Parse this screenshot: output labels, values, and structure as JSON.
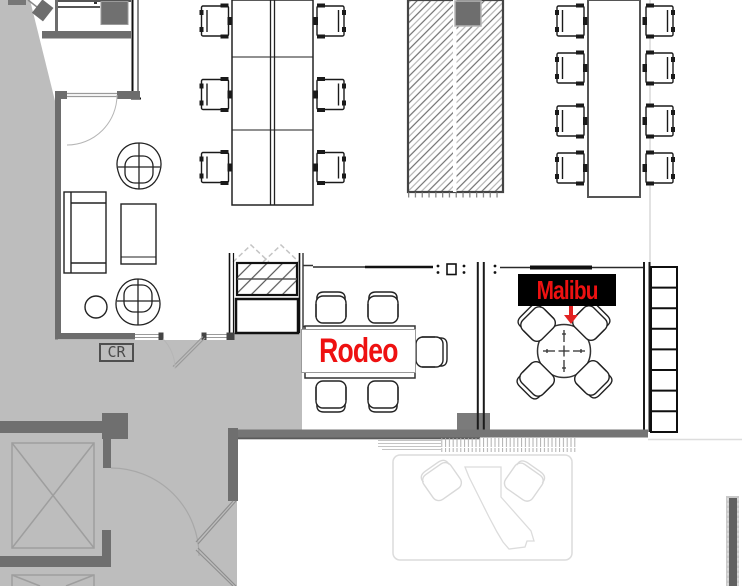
{
  "plan": {
    "title": "office-floor-plan",
    "rooms": [
      {
        "id": "rodeo",
        "label": "Rodeo",
        "label_color": "#ee1111",
        "label_bg": "#ffffff",
        "furniture": "rect-table-5-chairs"
      },
      {
        "id": "malibu",
        "label": "Malibu",
        "label_color": "#ee1111",
        "label_bg": "#000000",
        "furniture": "round-table-4-chairs",
        "marker": "red-down-arrow"
      }
    ],
    "badges": [
      {
        "id": "cr",
        "label": "CR"
      }
    ],
    "areas": [
      {
        "id": "open-desk-bank",
        "desks": 6,
        "chairs": 6
      },
      {
        "id": "long-table",
        "chairs": 8
      },
      {
        "id": "hatched-zone",
        "pattern": "diagonal-hatch"
      },
      {
        "id": "lounge",
        "items": [
          "sofa",
          "coffee-table",
          "2 lounge chairs",
          "side-table"
        ]
      },
      {
        "id": "locker-column",
        "cells": 8
      },
      {
        "id": "elevator-core",
        "shafts": 2
      },
      {
        "id": "ghost-rug",
        "items": [
          "california-outline",
          "2 chairs"
        ]
      }
    ],
    "colors": {
      "accent_red": "#ee1111",
      "outside_gray": "#bdbdbd",
      "wall_dark_gray": "#6d6d6d",
      "line_black": "#1a1a1a",
      "ghost_gray": "#dcdcdc"
    }
  }
}
